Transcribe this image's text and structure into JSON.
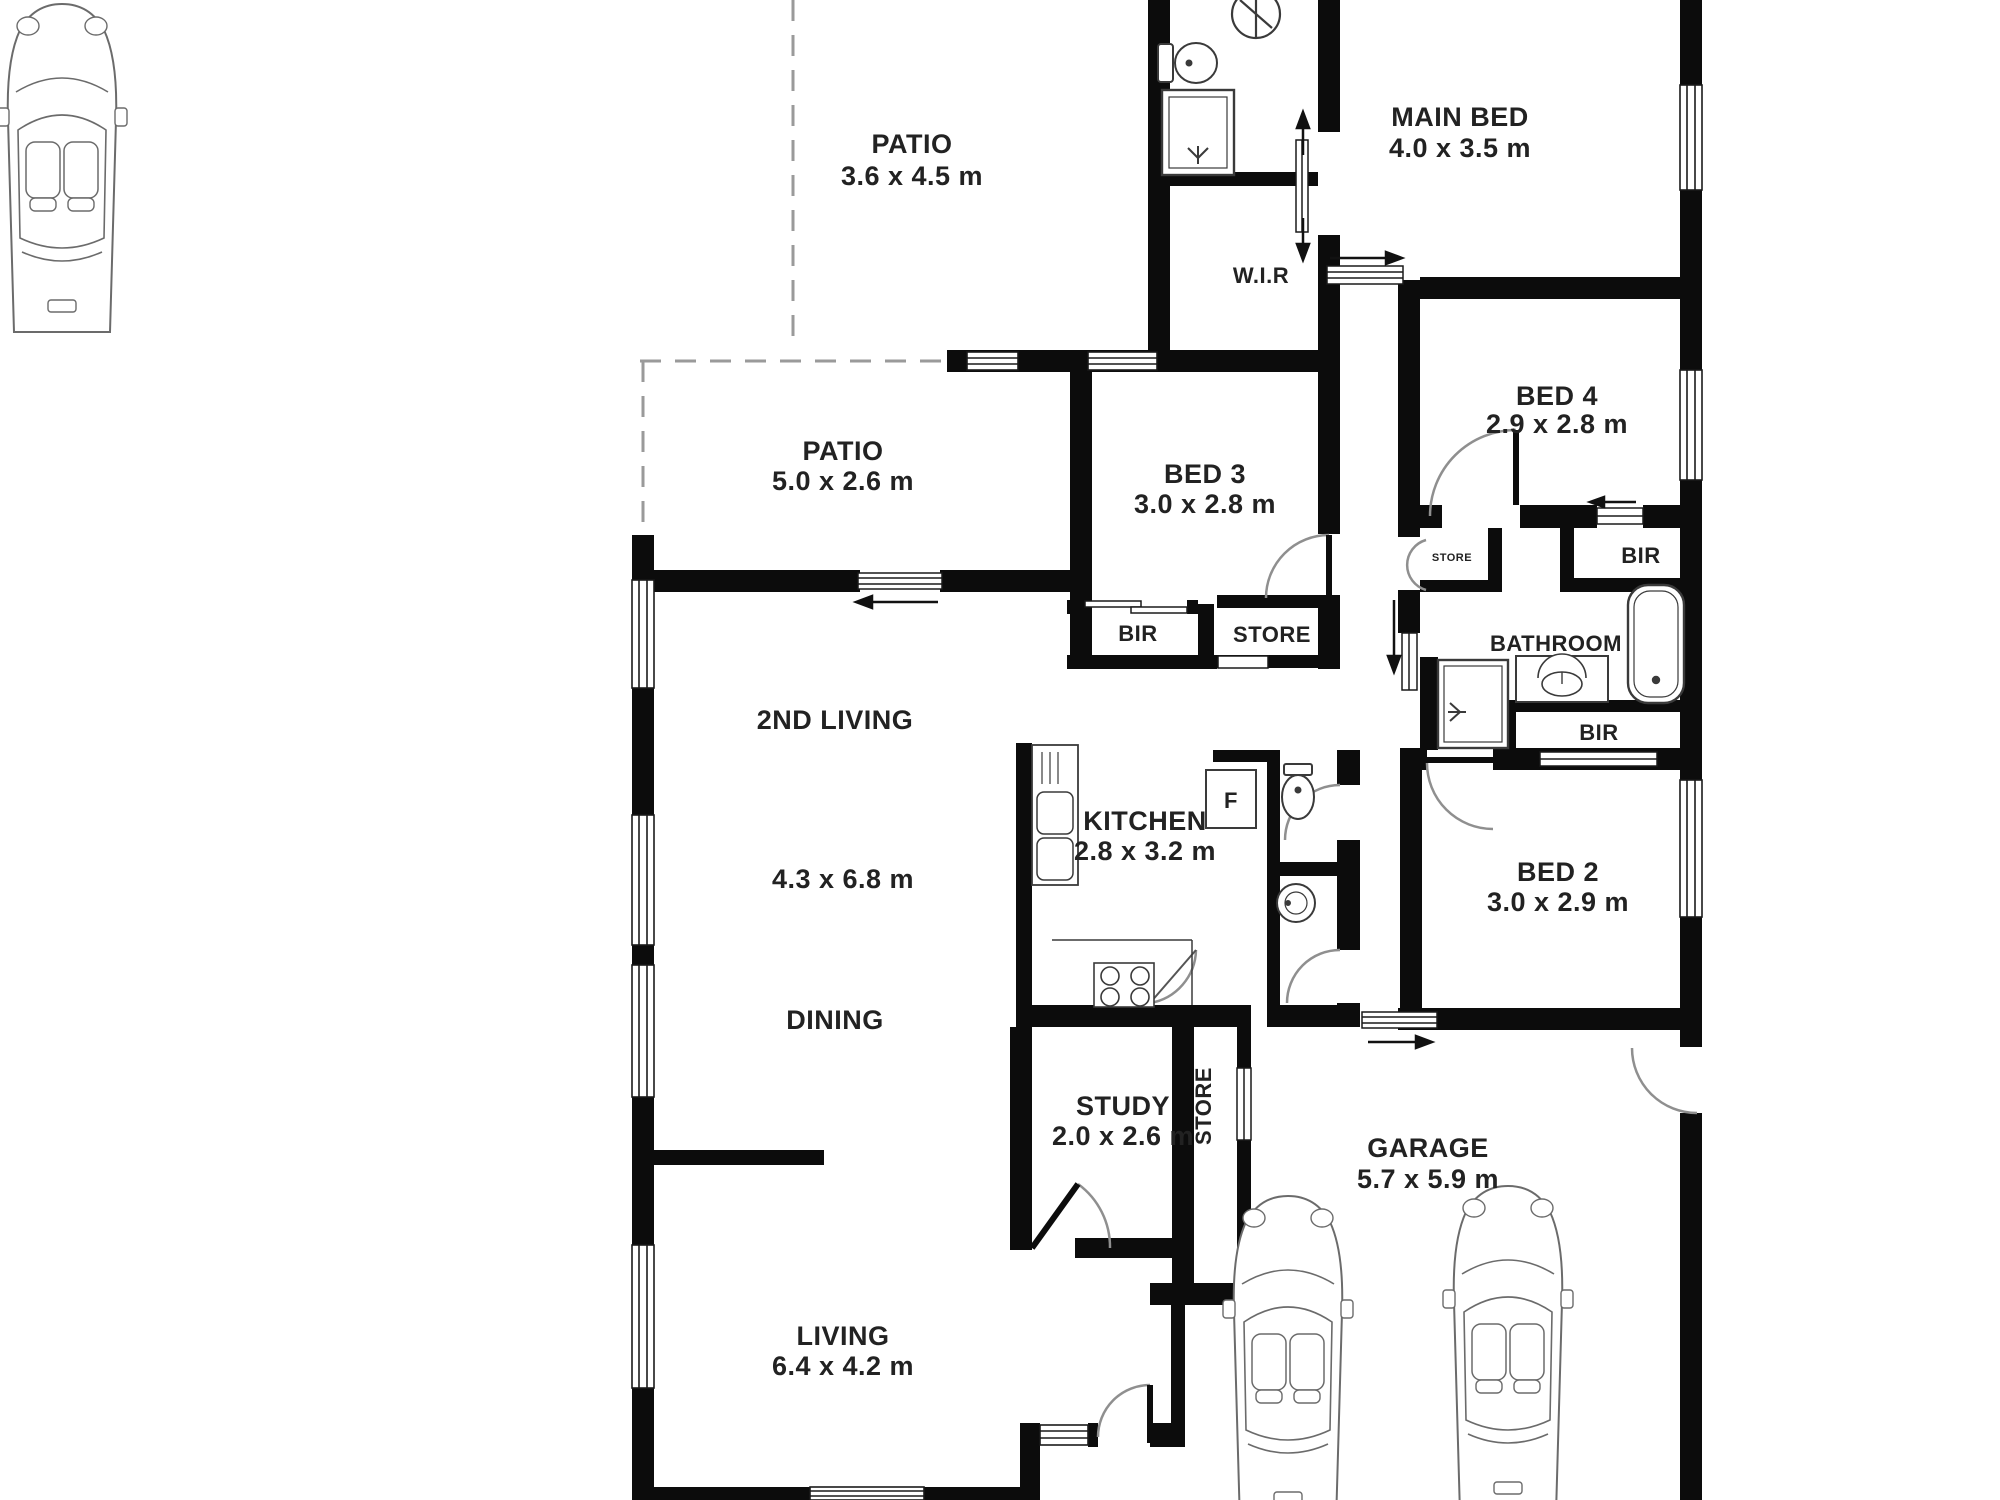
{
  "plan_type": "residential floor plan",
  "colors": {
    "background": "#ffffff",
    "walls": "#0c0c0c",
    "text": "#222222",
    "fixtures": "#3a3a3a",
    "door_arcs": "#8f8f8f",
    "patio_dashed": "#9a9a9a"
  },
  "rooms": {
    "patio_top": {
      "name": "PATIO",
      "dims": "3.6 x 4.5 m"
    },
    "patio_side": {
      "name": "PATIO",
      "dims": "5.0 x 2.6 m"
    },
    "main_bed": {
      "name": "MAIN BED",
      "dims": "4.0 x 3.5 m"
    },
    "wir": {
      "name": "W.I.R"
    },
    "bed2": {
      "name": "BED 2",
      "dims": "3.0 x 2.9 m"
    },
    "bed3": {
      "name": "BED 3",
      "dims": "3.0 x 2.8 m"
    },
    "bed4": {
      "name": "BED 4",
      "dims": "2.9 x 2.8 m"
    },
    "bathroom": {
      "name": "BATHROOM"
    },
    "second_living": {
      "name": "2ND LIVING",
      "dims": "4.3 x 6.8 m"
    },
    "dining": {
      "name": "DINING"
    },
    "kitchen": {
      "name": "KITCHEN",
      "dims": "2.8 x 3.2 m"
    },
    "study": {
      "name": "STUDY",
      "dims": "2.0 x 2.6 m"
    },
    "garage": {
      "name": "GARAGE",
      "dims": "5.7 x 5.9 m"
    },
    "living": {
      "name": "LIVING",
      "dims": "6.4 x 4.2 m"
    }
  },
  "closets": {
    "bir": "BIR",
    "store": "STORE"
  },
  "fixtures": {
    "fridge": "F"
  }
}
